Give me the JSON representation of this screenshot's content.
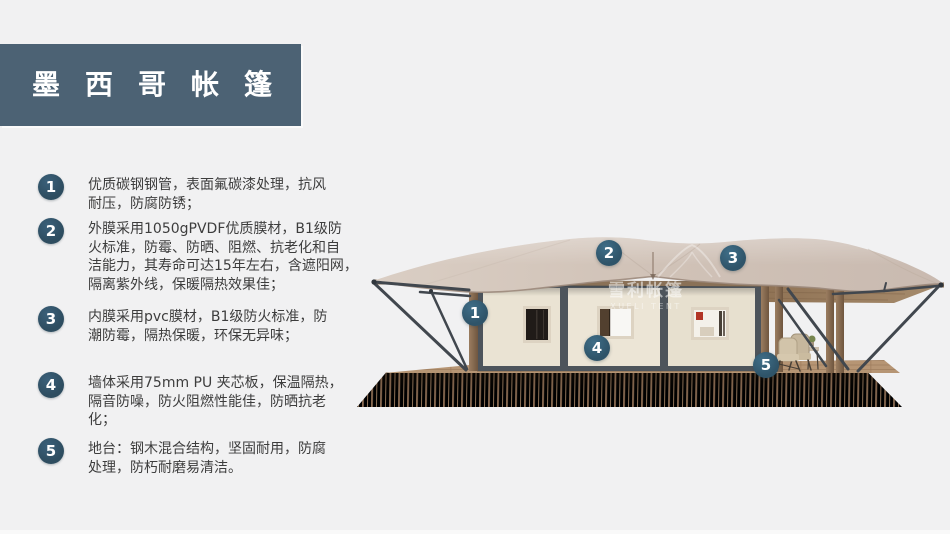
{
  "title": {
    "text": "墨西哥帐篷"
  },
  "features": [
    {
      "num": "1",
      "lines": [
        "优质碳钢钢管，表面氟碳漆处理，抗风",
        "耐压，防腐防锈；"
      ]
    },
    {
      "num": "2",
      "lines": [
        "外膜采用1050gPVDF优质膜材，B1级防",
        "火标准，防霉、防晒、阻燃、抗老化和自",
        "洁能力，其寿命可达15年左右，含遮阳网，",
        "隔离紫外线，保暖隔热效果佳；"
      ]
    },
    {
      "num": "3",
      "lines": [
        "内膜采用pvc膜材，B1级防火标准，防",
        "潮防霉，隔热保暖，环保无异味；"
      ]
    },
    {
      "num": "4",
      "lines": [
        "墙体采用75mm PU 夹芯板，保温隔热，",
        "隔音防噪，防火阻燃性能佳，防晒抗老",
        "化；"
      ]
    },
    {
      "num": "5",
      "lines": [
        "地台：钢木混合结构，坚固耐用，防腐",
        "处理，防朽耐磨易清洁。"
      ]
    }
  ],
  "diagram": {
    "markers": [
      {
        "label": "1"
      },
      {
        "label": "2"
      },
      {
        "label": "3"
      },
      {
        "label": "4"
      },
      {
        "label": "5"
      }
    ],
    "watermark": {
      "cn": "雪利帐篷",
      "en": "XUELI TENT"
    }
  },
  "colors": {
    "background": "#f1f1f2",
    "banner": "#4c6274",
    "badge": "#2e4d60",
    "marker": "#31586e",
    "roof": "#d1c3b8",
    "wall": "#e9e2d2",
    "wall_frame": "#4d545b",
    "deck": "#a38266",
    "text": "#3d3d3d"
  }
}
